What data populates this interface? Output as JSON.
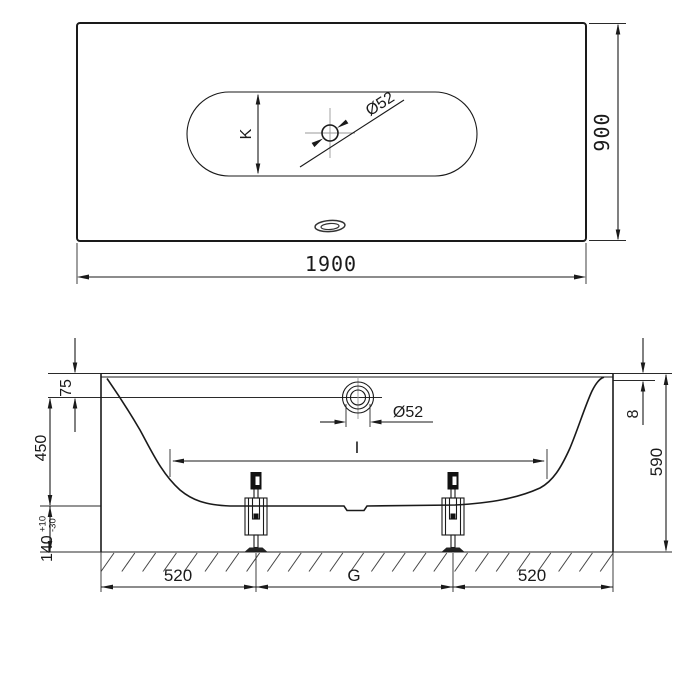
{
  "drawing": {
    "background": "#ffffff",
    "line_color": "#1a1a1a",
    "centerline_color": "#999999",
    "top_view": {
      "length": "1900",
      "width": "900",
      "drain_diameter": "Ø52",
      "drain_offset_label": "K"
    },
    "side_view": {
      "rim_to_overflow": "75",
      "inner_depth": "450",
      "base_clearance": "140",
      "base_clearance_tol_plus": "+10",
      "base_clearance_tol_minus": "-30",
      "rim_thickness": "8",
      "overall_height": "590",
      "drain_diameter": "Ø52",
      "inner_length_label": "I",
      "foot_offset_left": "520",
      "foot_spacing_label": "G",
      "foot_offset_right": "520"
    }
  }
}
